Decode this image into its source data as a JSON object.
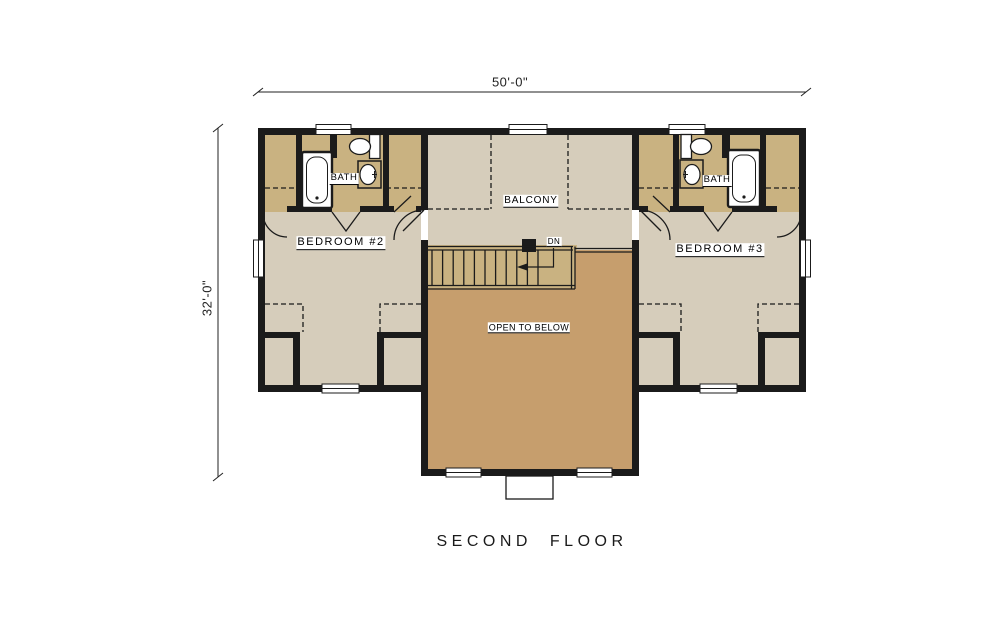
{
  "plan": {
    "title": "SECOND FLOOR",
    "dimensions": {
      "overall_width": "50'-0\"",
      "overall_depth": "32'-0\""
    },
    "labels": {
      "bedroom2": "BEDROOM #2",
      "bedroom3": "BEDROOM #3",
      "bath_left": "BATH",
      "bath_right": "BATH",
      "balcony": "BALCONY",
      "open_to_below": "OPEN TO BELOW",
      "stairs_down": "DN"
    },
    "colors": {
      "background": "#ffffff",
      "bedroom_floor": "#d6cdbb",
      "closet_and_stairs": "#c9b281",
      "open_to_below_floor": "#c69e6d",
      "walls": "#1b1b1b"
    }
  }
}
